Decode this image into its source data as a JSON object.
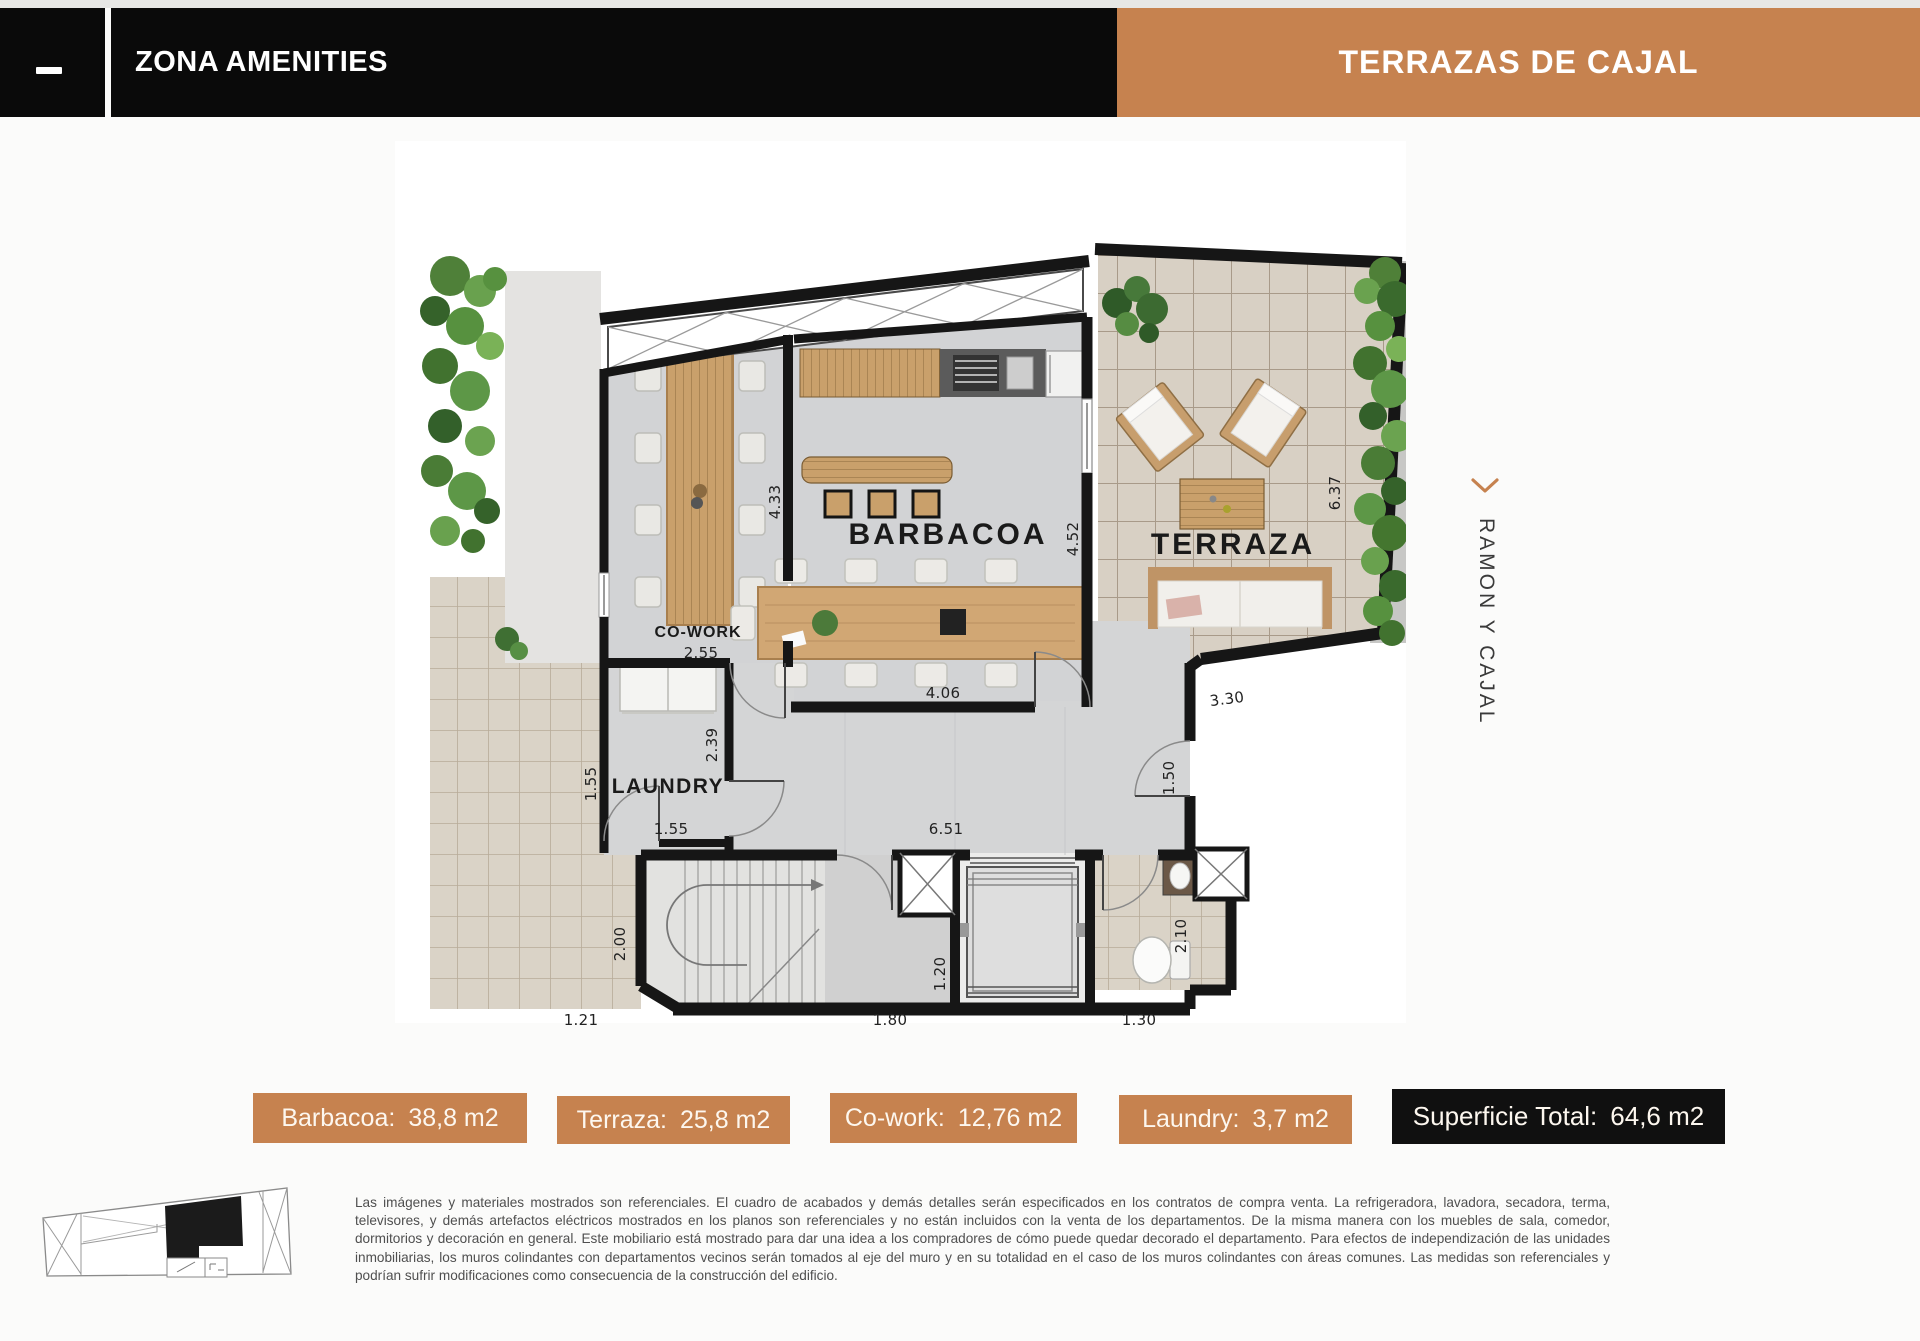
{
  "header": {
    "title": "ZONA AMENITIES",
    "brand": "TERRAZAS DE CAJAL"
  },
  "colors": {
    "accent_orange": "#C6824F",
    "header_black": "#0A0A0A",
    "total_badge_black": "#101010"
  },
  "icons": {
    "minimize": "minus-dash",
    "street_direction": "chevron-down"
  },
  "plan": {
    "room_labels": {
      "barbacoa": "BARBACOA",
      "terraza": "TERRAZA",
      "cowork": "CO-WORK",
      "laundry": "LAUNDRY"
    },
    "dims": {
      "d433": "4.33",
      "d452": "4.52",
      "d637": "6.37",
      "d255": "2.55",
      "d239": "2.39",
      "d155v": "1.55",
      "d155h": "1.55",
      "d406": "4.06",
      "d651": "6.51",
      "d330": "3.30",
      "d150": "1.50",
      "d200": "2.00",
      "d121": "1.21",
      "d180": "1.80",
      "d120": "1.20",
      "d130": "1.30",
      "d210": "2.10"
    }
  },
  "side_label": {
    "text": "RAMON Y CAJAL"
  },
  "badges": [
    {
      "label": "Barbacoa:",
      "value": "38,8 m2"
    },
    {
      "label": "Terraza:",
      "value": "25,8 m2"
    },
    {
      "label": "Co-work:",
      "value": "12,76 m2"
    },
    {
      "label": "Laundry:",
      "value": "3,7 m2"
    }
  ],
  "total_badge": {
    "label": "Superficie Total:",
    "value": "64,6 m2"
  },
  "disclaimer": "Las imágenes y materiales mostrados son referenciales. El cuadro de acabados y demás detalles serán especificados en los contratos de compra venta. La refrigeradora, lavadora, secadora, terma, televisores, y demás artefactos eléctricos mostrados en los planos son referenciales y no están incluidos con la venta de los departamentos. De la misma manera con los muebles de sala, comedor, dormitorios y decoración en general. Este mobiliario está mostrado para dar una idea a los compradores de cómo puede quedar decorado el departamento. Para efectos de independización de las unidades inmobiliarias, los muros colindantes con departamentos vecinos serán tomados al eje del muro y en su totalidad en el caso de los muros colindantes con áreas comunes. Las medidas son referenciales y podrían sufrir modificaciones como consecuencia de la construcción del edificio."
}
